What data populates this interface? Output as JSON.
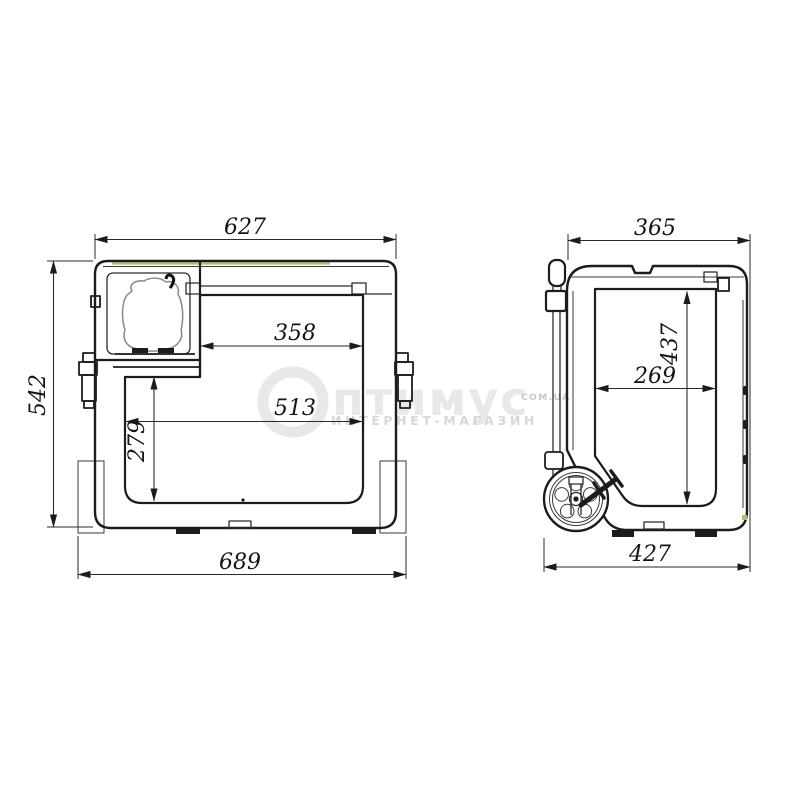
{
  "drawing": {
    "subject": "portable compressor cooler dimensional drawing, front and side views"
  },
  "front_view": {
    "dims": {
      "top_width": "627",
      "overall_height": "542",
      "upper_inner_width": "358",
      "inner_width": "513",
      "lower_inner_height": "279",
      "base_width": "689"
    }
  },
  "side_view": {
    "dims": {
      "top_depth": "365",
      "inner_height": "437",
      "inner_depth": "269",
      "base_depth": "427"
    }
  },
  "watermark": {
    "brand_ring_letter": "О",
    "brand_text": "птимус",
    "domain_label": "COM.UA",
    "tagline": "ИНТЕРНЕТ-МАГАЗИН"
  },
  "colors": {
    "line_dark": "#1c1c1c",
    "dim_line": "#2a2a2a",
    "compressor_gray": "#8f8f8f",
    "gasket_yellow": "#b9b96a",
    "watermark_light": "#e8e8e8",
    "watermark_mid": "#d7d7d7",
    "watermark_small": "#c6c6c6",
    "background": "#ffffff"
  }
}
